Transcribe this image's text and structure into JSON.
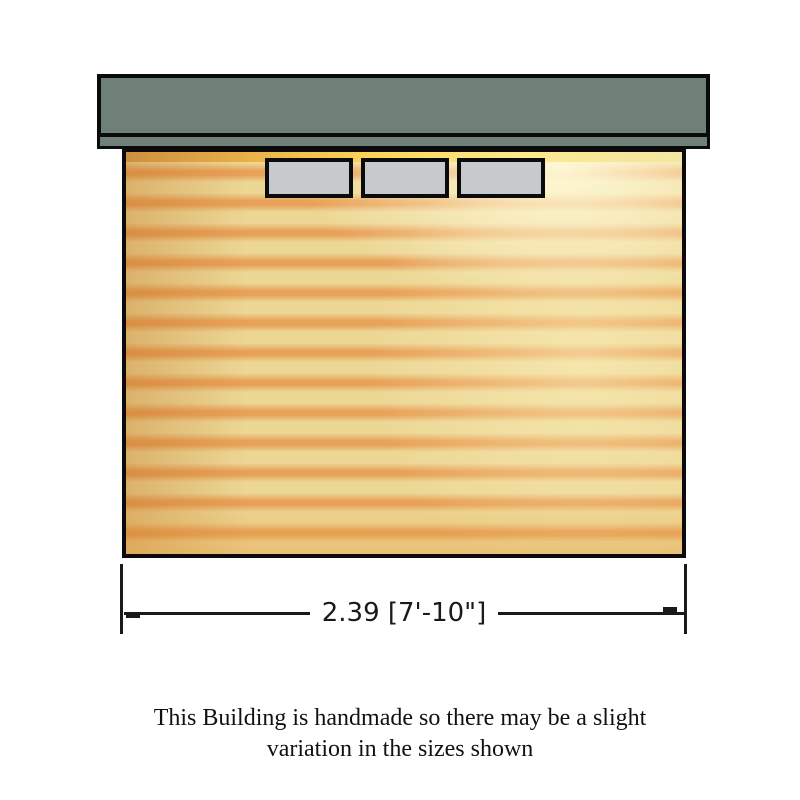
{
  "colors": {
    "roof": "#6e8077",
    "outline": "#0b0b0b",
    "wall_base": "#ecd795",
    "wall_stripe": "#e8a158",
    "window_fill": "#c7cacc",
    "line": "#1a1a1a"
  },
  "building": {
    "type": "shed-elevation",
    "windows_count": 3
  },
  "dimension": {
    "width_label": "2.39 [7'-10\"]"
  },
  "caption": {
    "line1": "This Building is handmade so there may be a slight",
    "line2": "variation in the sizes shown"
  }
}
